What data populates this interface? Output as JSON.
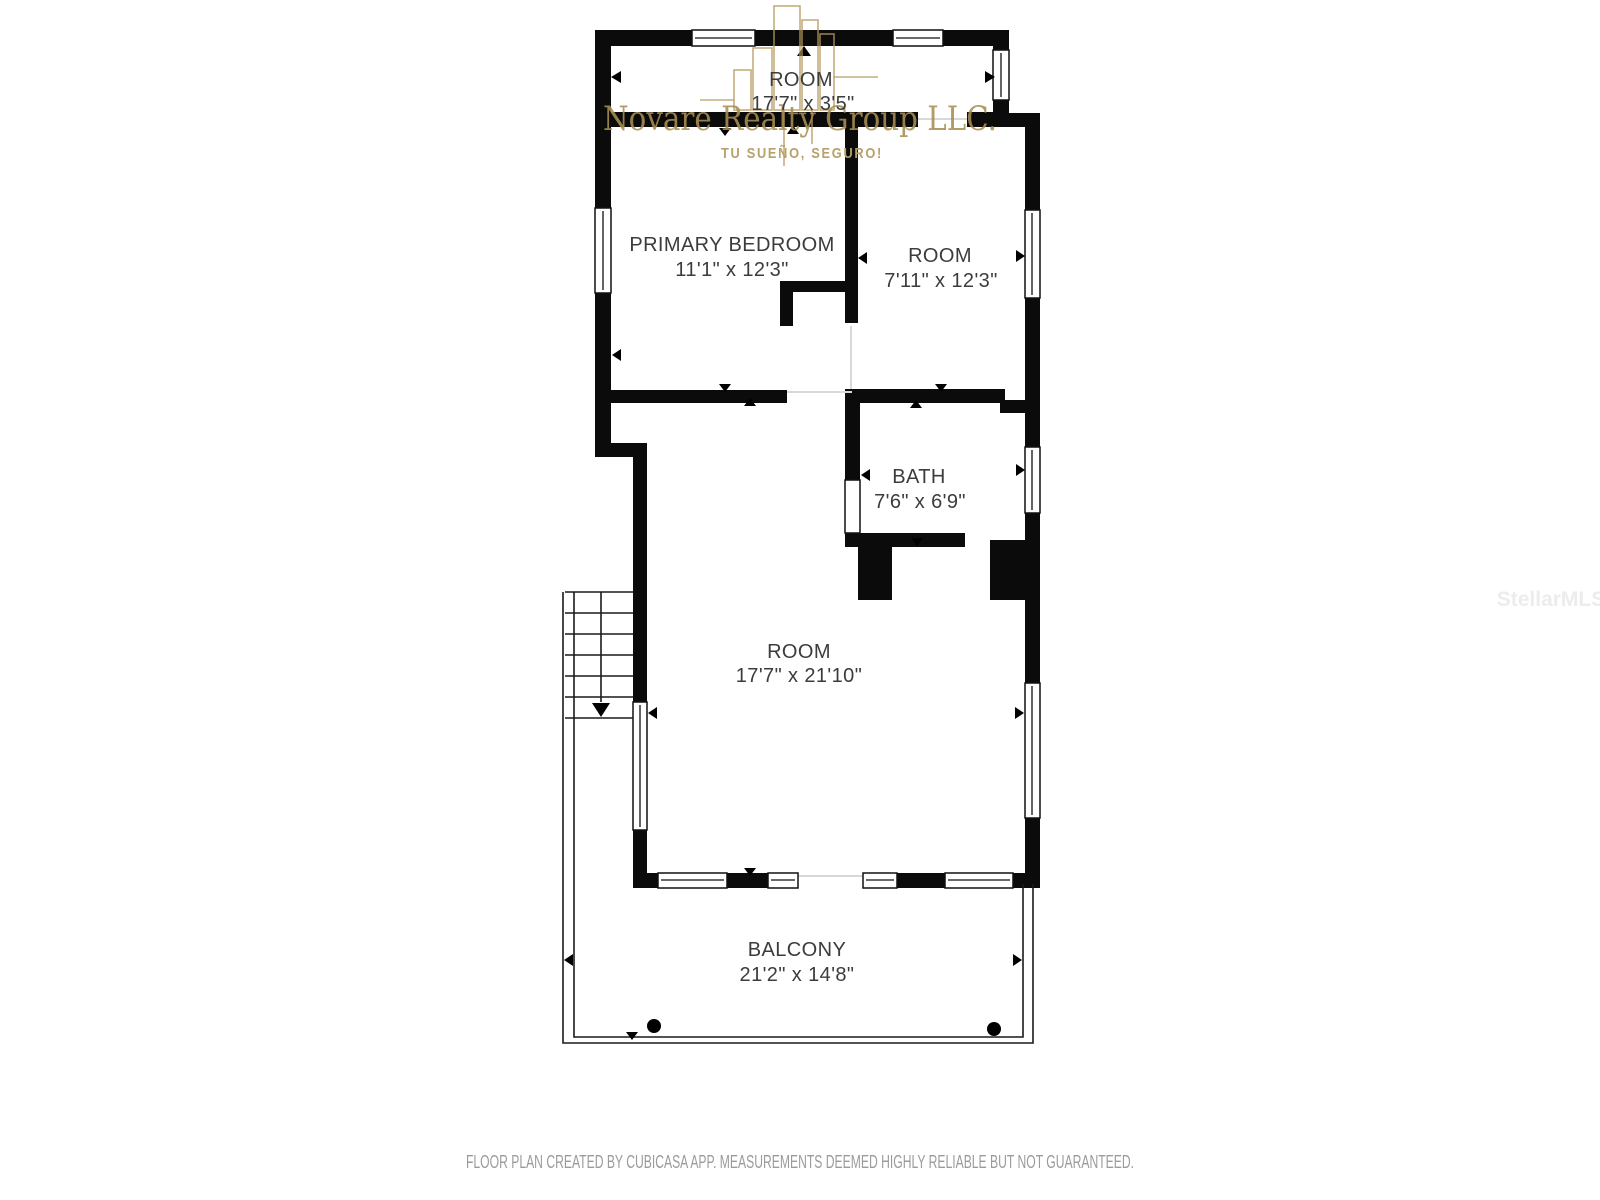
{
  "colors": {
    "wall": "#0b0b0b",
    "label": "#3c3c3c",
    "gold": "#a98e52",
    "gold_light": "#b7a06a",
    "mls": "#ececec",
    "footer": "#9b9b9b"
  },
  "rooms": [
    {
      "name": "ROOM",
      "dims": "17'7\" x 3'5\""
    },
    {
      "name": "PRIMARY BEDROOM",
      "dims": "11'1\" x 12'3\""
    },
    {
      "name": "ROOM",
      "dims": "7'11\" x 12'3\""
    },
    {
      "name": "BATH",
      "dims": "7'6\" x 6'9\""
    },
    {
      "name": "ROOM",
      "dims": "17'7\" x 21'10\""
    },
    {
      "name": "BALCONY",
      "dims": "21'2\" x 14'8\""
    }
  ],
  "watermark": {
    "brand": "Novare Realty Group LLC.",
    "tagline": "TU SUEÑO, SEGURO!",
    "mls_badge": "StellarMLS"
  },
  "footer": {
    "disclaimer": "FLOOR PLAN CREATED BY CUBICASA APP. MEASUREMENTS DEEMED HIGHLY RELIABLE BUT NOT GUARANTEED."
  }
}
